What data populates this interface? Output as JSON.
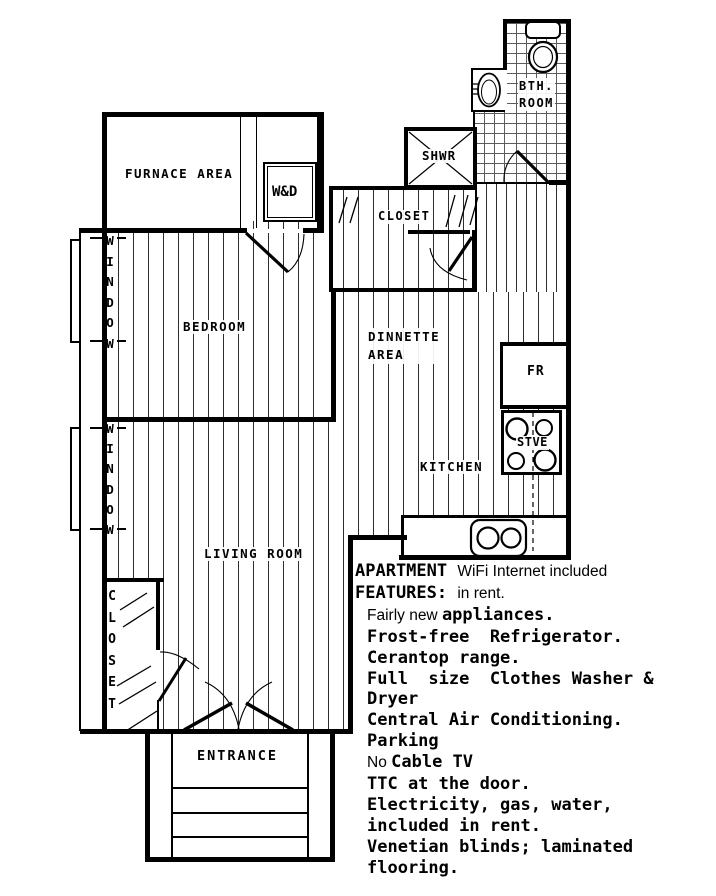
{
  "plan": {
    "rooms": {
      "furnace": "FURNACE AREA",
      "wd": "W&D",
      "bedroom": "BEDROOM",
      "closet_top": "CLOSET",
      "dinnette": "DINNETTE\nAREA",
      "kitchen": "KITCHEN",
      "living": "LIVING ROOM",
      "entrance": "ENTRANCE",
      "shower": "SHWR",
      "bathroom": "BTH.\nROOM",
      "fridge": "FR",
      "stove": "STVE",
      "window": "WINDOW",
      "closet_lr": "CLOSET"
    },
    "fixtures": [
      "toilet",
      "bath-sink",
      "kitchen-sink",
      "stove-burners",
      "shower-pan"
    ]
  },
  "features": {
    "lines": [
      [
        {
          "t": "APARTMENT ",
          "f": "mono"
        },
        {
          "t": "WiFi Internet included",
          "f": "sans"
        }
      ],
      [
        {
          "t": "FEATURES: ",
          "f": "mono"
        },
        {
          "t": "in rent.",
          "f": "sans"
        }
      ],
      [
        {
          "t": "Fairly new ",
          "f": "sans"
        },
        {
          "t": "appliances.",
          "f": "mono"
        }
      ],
      [
        {
          "t": "Frost-free  Refrigerator.",
          "f": "mono"
        }
      ],
      [
        {
          "t": "Cerantop range.",
          "f": "mono"
        }
      ],
      [
        {
          "t": "Full  size  Clothes Washer &",
          "f": "mono"
        }
      ],
      [
        {
          "t": "Dryer",
          "f": "mono"
        }
      ],
      [
        {
          "t": "Central Air Conditioning.",
          "f": "mono"
        }
      ],
      [
        {
          "t": "Parking",
          "f": "mono"
        }
      ],
      [
        {
          "t": "No ",
          "f": "sans"
        },
        {
          "t": "Cable TV",
          "f": "mono"
        }
      ],
      [
        {
          "t": "TTC at the door.",
          "f": "mono"
        }
      ],
      [
        {
          "t": "Electricity, gas, water,",
          "f": "mono"
        }
      ],
      [
        {
          "t": "included in rent.",
          "f": "mono"
        }
      ],
      [
        {
          "t": "Venetian blinds; laminated",
          "f": "mono"
        }
      ],
      [
        {
          "t": "flooring.",
          "f": "mono"
        }
      ]
    ]
  },
  "colors": {
    "ink": "#000000",
    "floor_line": "#2e2e2e",
    "tile_line": "#5c5c5c",
    "background": "#ffffff"
  }
}
